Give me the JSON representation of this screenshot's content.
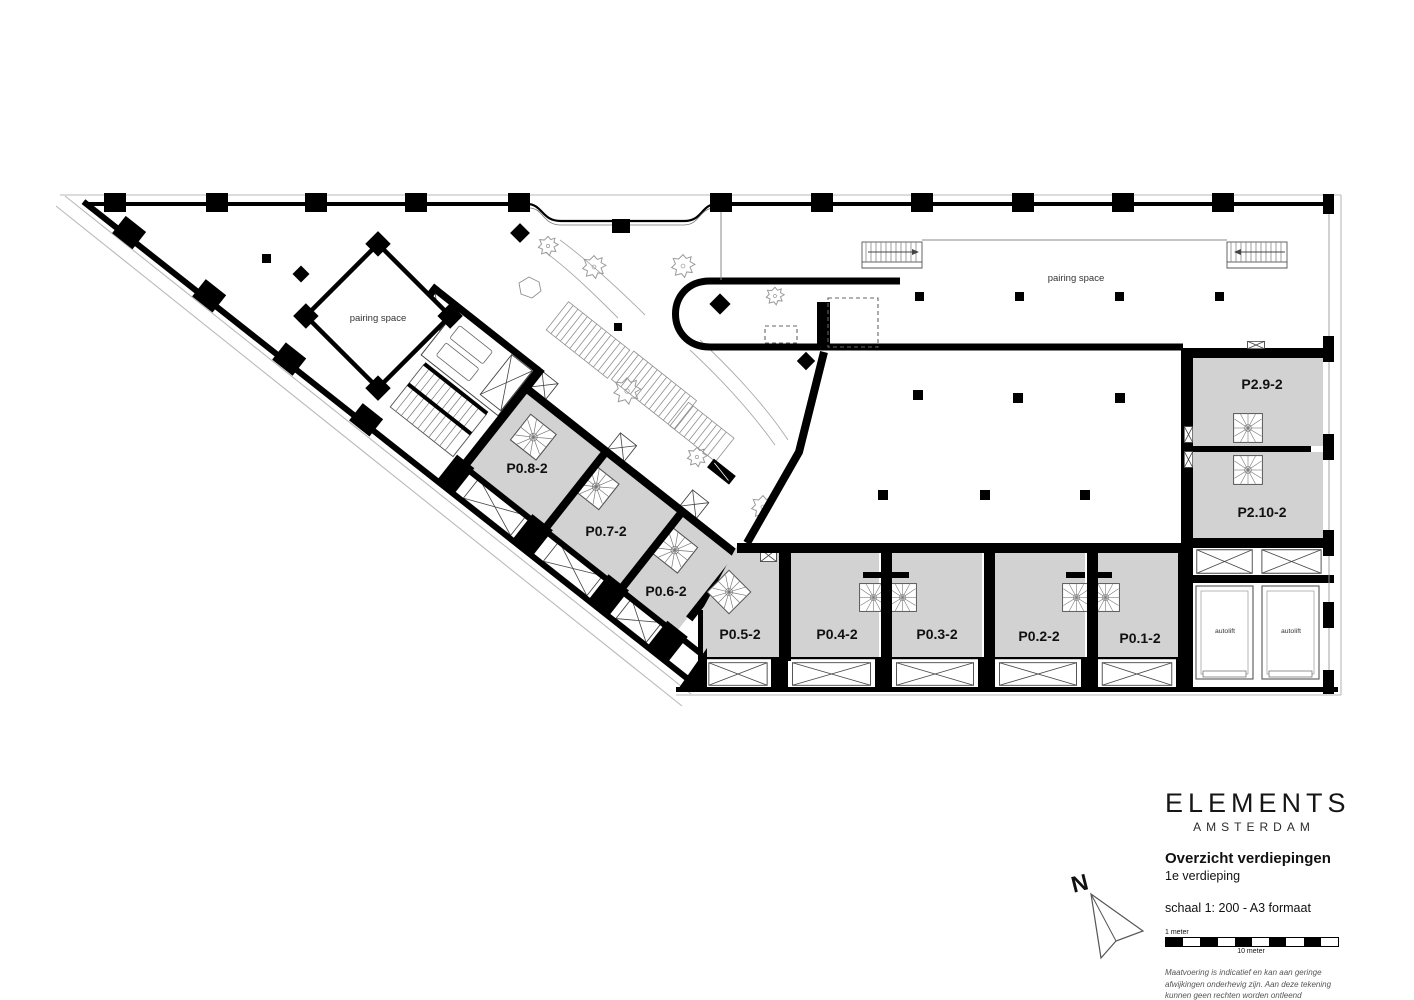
{
  "colors": {
    "wall": "#000000",
    "unit_fill": "#d2d2d2",
    "sketch": "#9a9a9a"
  },
  "plan": {
    "left_zone": {
      "label": "pairing space"
    },
    "right_zone": {
      "label": "pairing space"
    },
    "units": [
      {
        "id": "P0.8-2",
        "label": "P0.8-2"
      },
      {
        "id": "P0.7-2",
        "label": "P0.7-2"
      },
      {
        "id": "P0.6-2",
        "label": "P0.6-2"
      },
      {
        "id": "P0.5-2",
        "label": "P0.5-2"
      },
      {
        "id": "P0.4-2",
        "label": "P0.4-2"
      },
      {
        "id": "P0.3-2",
        "label": "P0.3-2"
      },
      {
        "id": "P0.2-2",
        "label": "P0.2-2"
      },
      {
        "id": "P0.1-2",
        "label": "P0.1-2"
      },
      {
        "id": "P2.9-2",
        "label": "P2.9-2"
      },
      {
        "id": "P2.10-2",
        "label": "P2.10-2"
      }
    ],
    "autolifts": [
      {
        "label": "autolift"
      },
      {
        "label": "autolift"
      }
    ]
  },
  "compass": {
    "label": "N"
  },
  "title_block": {
    "brand": "ELEMENTS",
    "brand_sub": "AMSTERDAM",
    "doc_title": "Overzicht verdiepingen",
    "doc_subtitle": "1e verdieping",
    "scale_note": "schaal 1: 200 - A3 formaat",
    "scale_bar": {
      "top_label": "1 meter",
      "bottom_label": "10 meter"
    },
    "disclaimer_lines": [
      "Maatvoering is indicatief en kan aan geringe",
      "afwijkingen onderhevig zijn. Aan deze tekening",
      "kunnen geen rechten worden ontleend"
    ]
  }
}
